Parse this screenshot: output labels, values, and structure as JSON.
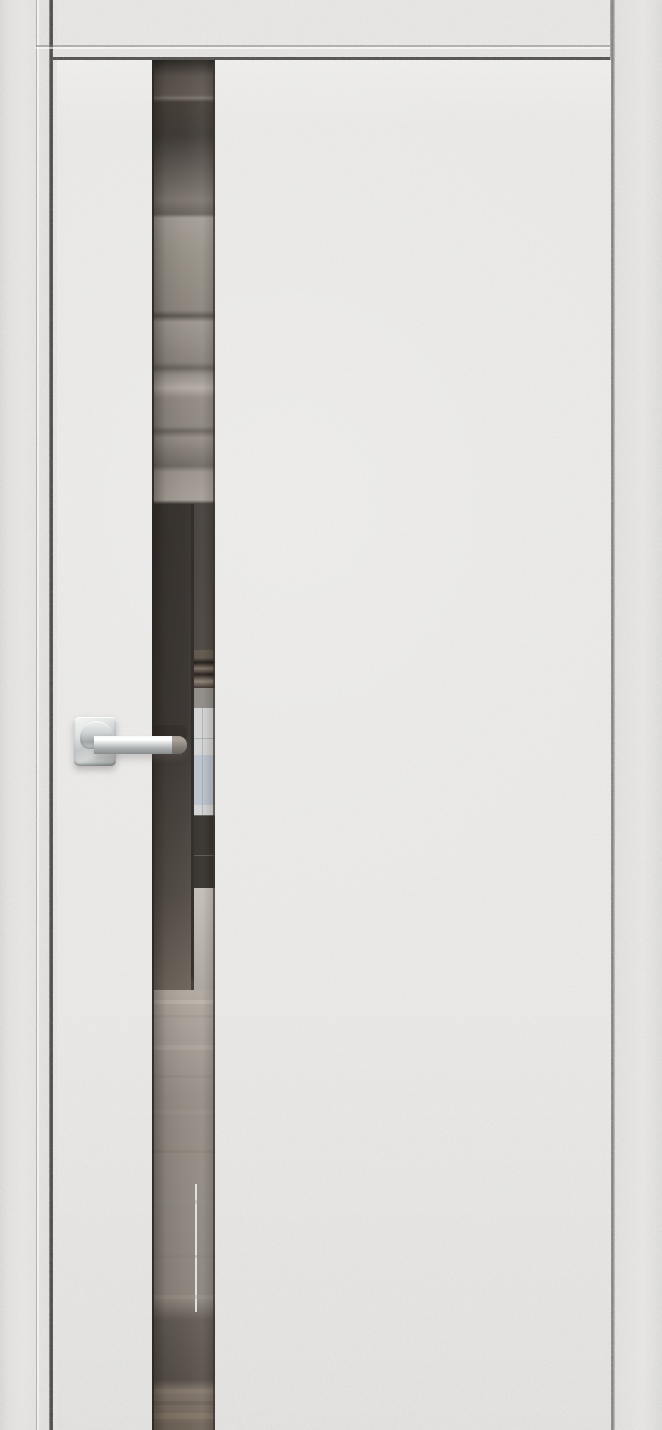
{
  "meta": {
    "subject": "Product photo: interior door with light grey stucco-textured finish, full-height smoked mirror insert strip reflecting a room, and a polished chrome lever handle on a square rosette",
    "canvas": {
      "width": 662,
      "height": 1430
    }
  },
  "frame": {
    "casing_color": "#e1e0de",
    "reveal_color": "#dedddb",
    "seam_dark_color": "#3c3a38",
    "seam_medium_color": "#6b6967"
  },
  "door": {
    "surface_color": "#e4e3e1",
    "top_seam_color": "#4b4947"
  },
  "mirror": {
    "finish": "smoked-mirror",
    "edge_left_color": "#2b2723",
    "edge_right_color": "#3a352f",
    "gradient_stops": [
      {
        "y": 0,
        "color": "#554e47"
      },
      {
        "y": 35,
        "color": "#5f5850"
      },
      {
        "y": 38,
        "color": "#7b746c"
      },
      {
        "y": 42,
        "color": "#474139"
      },
      {
        "y": 75,
        "color": "#413c38"
      },
      {
        "y": 140,
        "color": "#7f7871"
      },
      {
        "y": 154,
        "color": "#6b655e"
      },
      {
        "y": 158,
        "color": "#a39d96"
      },
      {
        "y": 190,
        "color": "#989289"
      },
      {
        "y": 250,
        "color": "#8b857d"
      },
      {
        "y": 256,
        "color": "#5f5952"
      },
      {
        "y": 262,
        "color": "#9c968e"
      },
      {
        "y": 302,
        "color": "#88827a"
      },
      {
        "y": 308,
        "color": "#6b655e"
      },
      {
        "y": 314,
        "color": "#928c84"
      },
      {
        "y": 328,
        "color": "#b2aba3"
      },
      {
        "y": 338,
        "color": "#918a82"
      },
      {
        "y": 366,
        "color": "#8d8680"
      },
      {
        "y": 371,
        "color": "#6d6760"
      },
      {
        "y": 378,
        "color": "#948d85"
      },
      {
        "y": 406,
        "color": "#726c65"
      },
      {
        "y": 412,
        "color": "#9b948c"
      },
      {
        "y": 440,
        "color": "#a59e96"
      },
      {
        "y": 444,
        "color": "#3e3935"
      },
      {
        "y": 590,
        "color": "#423d39"
      },
      {
        "y": 840,
        "color": "#4c453f"
      },
      {
        "y": 915,
        "color": "#5a534c"
      },
      {
        "y": 922,
        "color": "#b2aba2"
      },
      {
        "y": 970,
        "color": "#a59e96"
      },
      {
        "y": 1040,
        "color": "#948d85"
      },
      {
        "y": 1240,
        "color": "#8b847c"
      },
      {
        "y": 1260,
        "color": "#625b54"
      },
      {
        "y": 1320,
        "color": "#575049"
      },
      {
        "y": 1330,
        "color": "#7e7369"
      },
      {
        "y": 1370,
        "color": "#6f6459"
      }
    ],
    "floor_streaks": [
      {
        "y": 940,
        "h": 4,
        "color": "#c3bdb4",
        "opacity": 0.5
      },
      {
        "y": 955,
        "h": 3,
        "color": "#9a938b",
        "opacity": 0.4
      },
      {
        "y": 985,
        "h": 5,
        "color": "#b5aea5",
        "opacity": 0.45
      },
      {
        "y": 1015,
        "h": 3,
        "color": "#8d867e",
        "opacity": 0.35
      },
      {
        "y": 1050,
        "h": 4,
        "color": "#a39c93",
        "opacity": 0.3
      },
      {
        "y": 1090,
        "h": 3,
        "color": "#7d766e",
        "opacity": 0.3
      },
      {
        "y": 1140,
        "h": 4,
        "color": "#968f87",
        "opacity": 0.3
      },
      {
        "y": 1195,
        "h": 3,
        "color": "#847d75",
        "opacity": 0.3
      },
      {
        "y": 1235,
        "h": 4,
        "color": "#9e978e",
        "opacity": 0.35
      },
      {
        "y": 1329,
        "h": 5,
        "color": "#8a7c6e",
        "opacity": 0.5
      },
      {
        "y": 1341,
        "h": 4,
        "color": "#65594e",
        "opacity": 0.5
      },
      {
        "y": 1353,
        "h": 6,
        "color": "#93846f",
        "opacity": 0.4
      },
      {
        "y": 1363,
        "h": 4,
        "color": "#6e6154",
        "opacity": 0.4
      }
    ]
  },
  "reflection": {
    "wall_edge_color": "#2b2724",
    "window_color": "#d2d3d3",
    "window_sky_color": "#b6bec9",
    "mullion_color": "#9aa0a8",
    "sofa_color": "#35302b",
    "sofa_highlight_color": "#8a857d",
    "bright_edge_color": "#eceae6",
    "handle_reflection_color": "#38322d"
  },
  "handle": {
    "finish": "polished-chrome",
    "lever_tip_tint": "rgba(86,70,56,0.5)"
  }
}
